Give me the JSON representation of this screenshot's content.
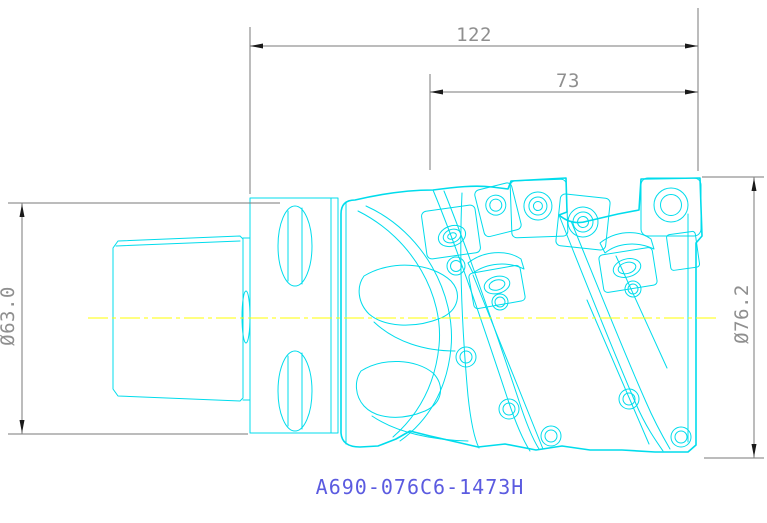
{
  "drawing": {
    "part_number": "A690-076C6-1473H",
    "dimensions": {
      "overall_length": "122",
      "cutting_length": "73",
      "left_diameter": "Ø63.0",
      "right_diameter": "Ø76.2"
    },
    "colors": {
      "geometry": "#00dcec",
      "centerline": "#ffff00",
      "dimension_lines": "#7a7a7a",
      "dimension_text": "#8f8f8f",
      "arrowheads": "#1a1a1a",
      "part_number_text": "#5b5be0",
      "background": "#ffffff"
    }
  }
}
